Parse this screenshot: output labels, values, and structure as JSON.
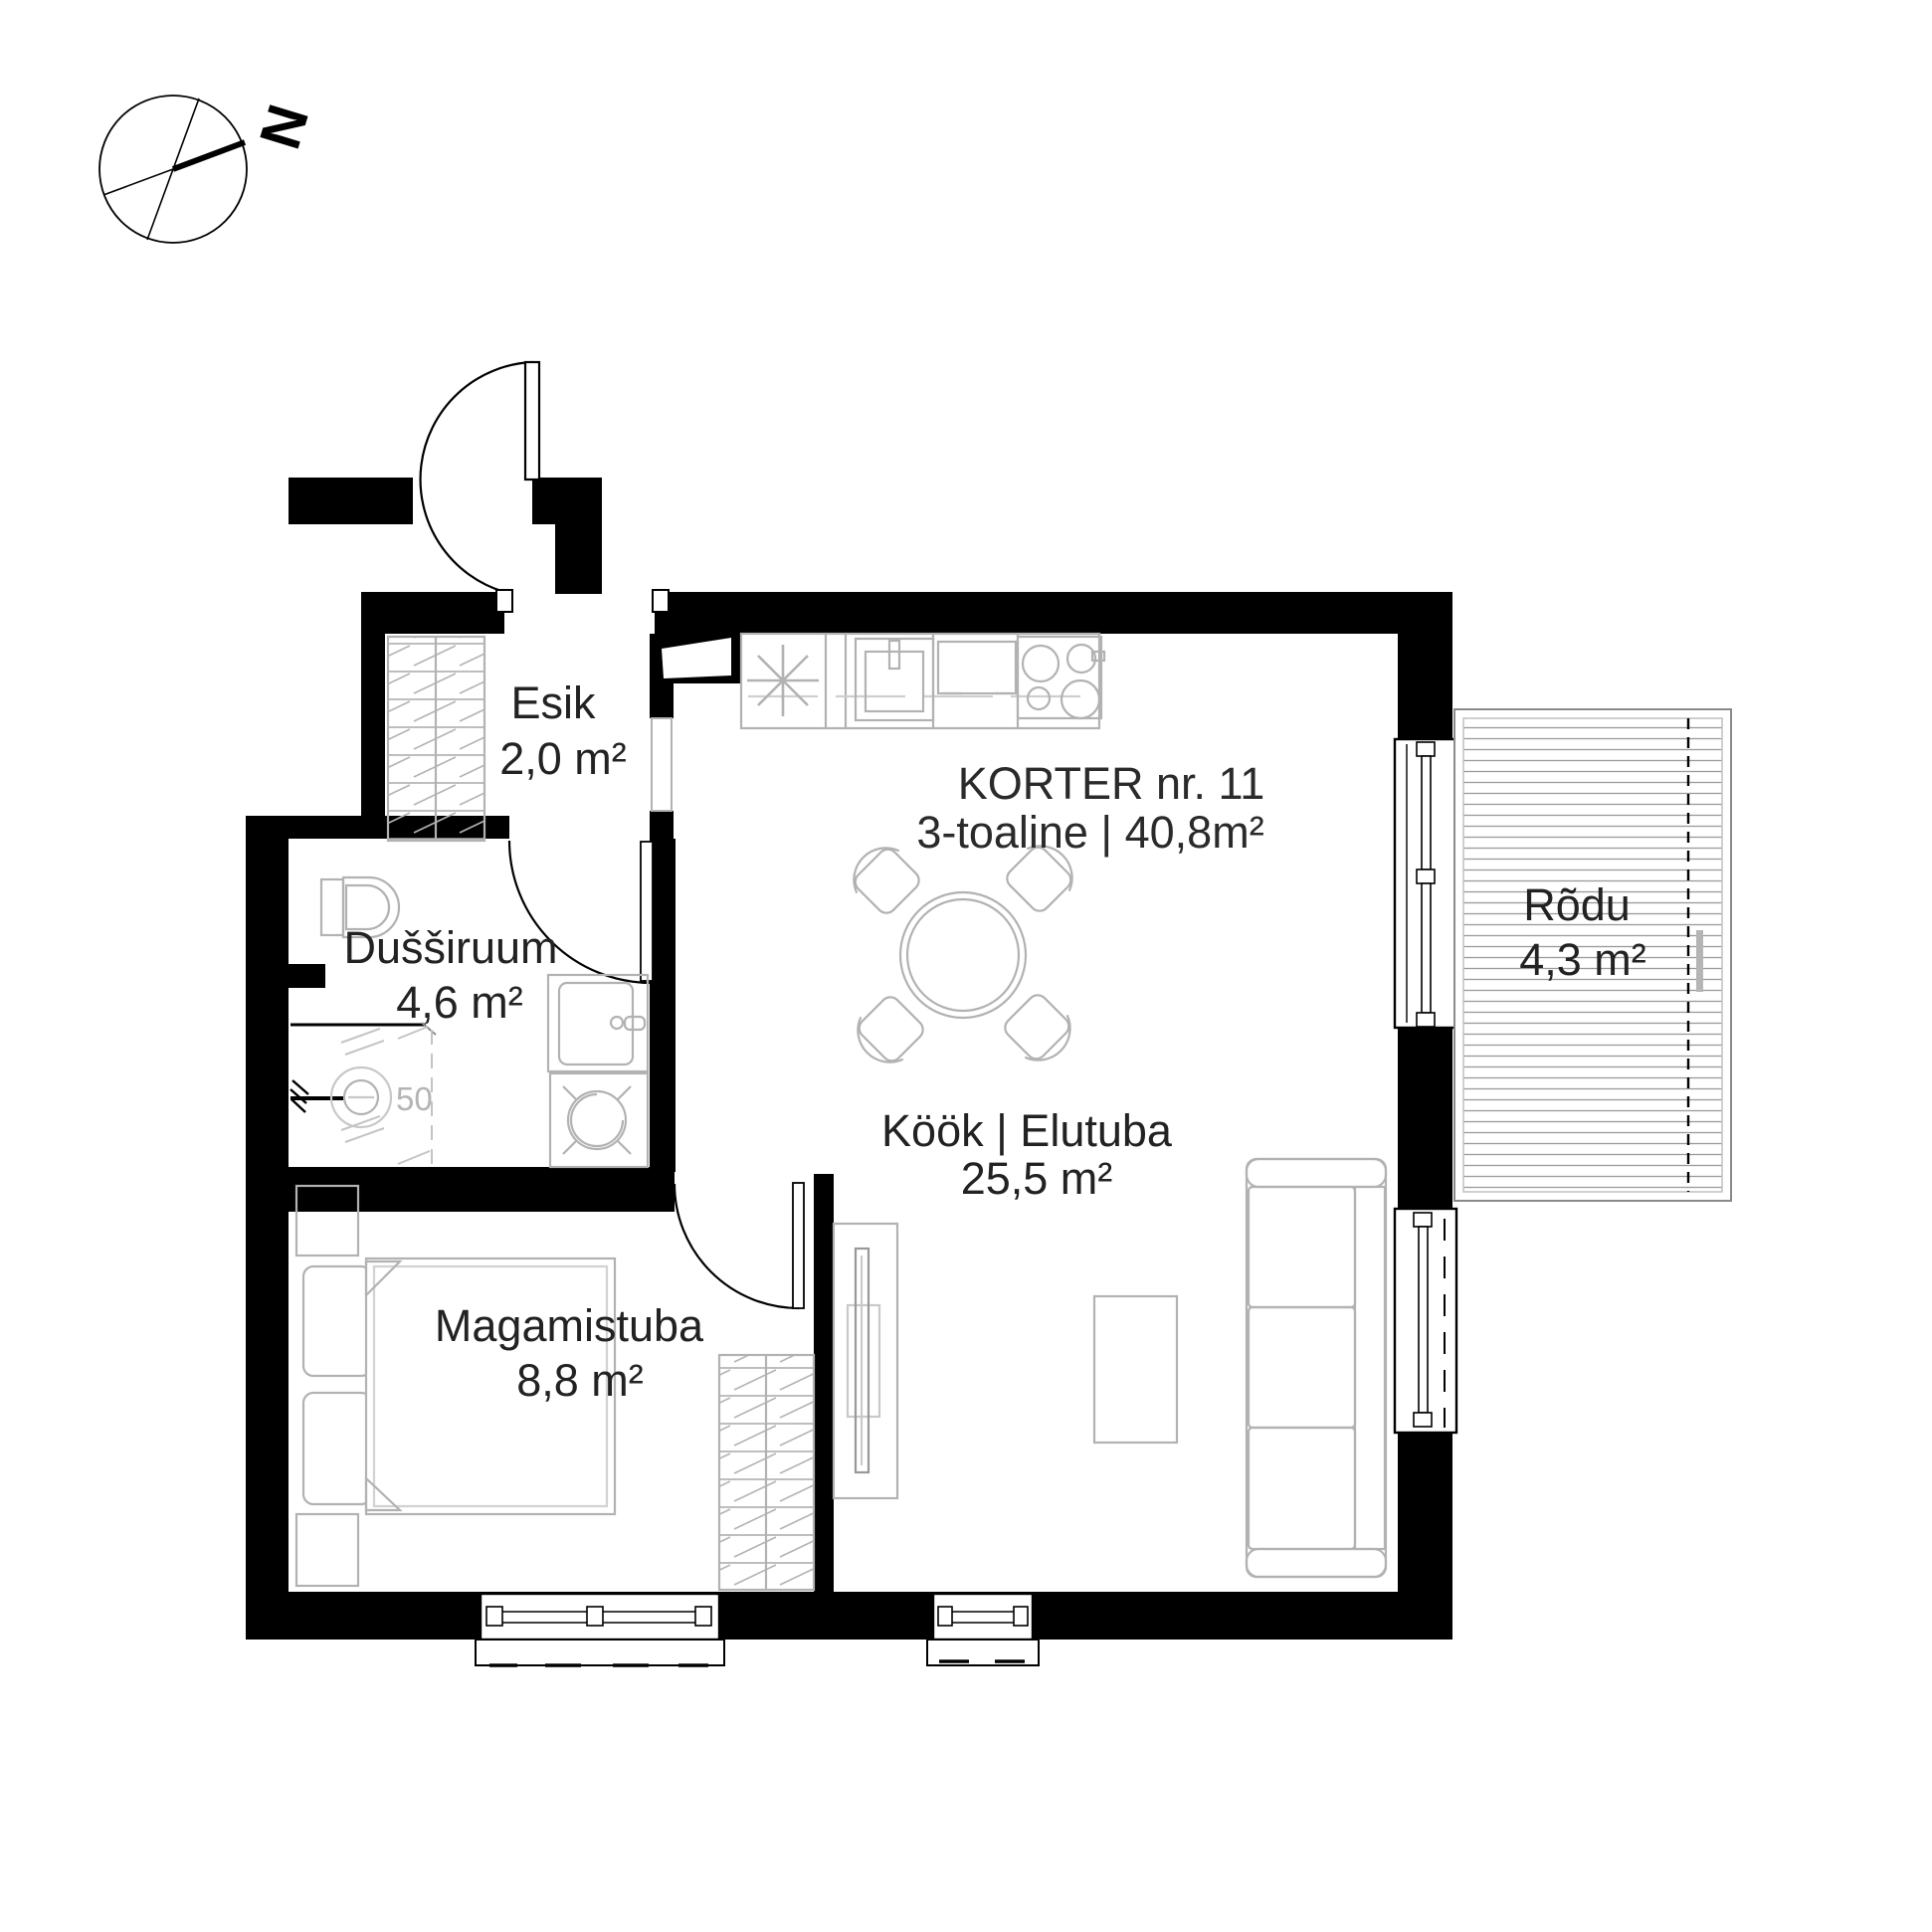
{
  "compass": {
    "letter": "N"
  },
  "title": {
    "line1": "KORTER nr. 11",
    "line2": "3-toaline | 40,8m²"
  },
  "rooms": {
    "esik": {
      "name": "Esik",
      "area": "2,0 m²"
    },
    "dussiruum": {
      "name": "Dušširuum",
      "area": "4,6 m²"
    },
    "kook_elutuba": {
      "name": "Köök | Elutuba",
      "area": "25,5 m²"
    },
    "magamistuba": {
      "name": "Magamistuba",
      "area": "8,8 m²"
    },
    "rodu": {
      "name": "Rõdu",
      "area": "4,3 m²"
    }
  },
  "annotations": {
    "shower_drain_diameter": "50"
  },
  "colors": {
    "wall": "#000000",
    "furniture_outline": "#b2b2b2",
    "label_text": "#222222",
    "balcony_deck_line": "#9a9a9a",
    "background": "#ffffff"
  }
}
